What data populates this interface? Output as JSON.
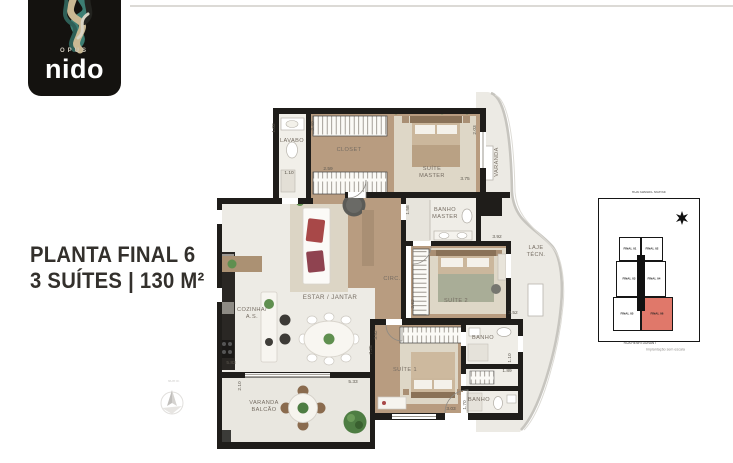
{
  "logo": {
    "brand_top": "OPUS",
    "brand": "nido"
  },
  "title": {
    "line1": "PLANTA FINAL 6",
    "line2": "3 SUÍTES | 130 M²"
  },
  "plan": {
    "rooms": {
      "lavabo": "LAVABO",
      "closet": "CLOSET",
      "suite_master": [
        "SUÍTE",
        "MASTER"
      ],
      "varanda": "VARANDA",
      "banho_master": [
        "BANHO",
        "MASTER"
      ],
      "suite_2": "SUÍTE 2",
      "laje_tecn": [
        "LAJE",
        "TÉCN."
      ],
      "circ": "CIRC.",
      "estar_jantar": "ESTAR / JANTAR",
      "cozinha": [
        "COZINHA/",
        "A.S."
      ],
      "varanda_balcao": [
        "VARANDA",
        "BALCÃO"
      ],
      "suite_1": "SUÍTE 1",
      "banho_1": "BANHO",
      "banho_2": "BANHO"
    },
    "dims": [
      "1.02",
      "1.10",
      "2.40",
      "2.59",
      "2.03",
      "3.75",
      "1.58",
      "3.92",
      "2.62",
      "3.52",
      "7.25",
      "5.83",
      "2.10",
      "5.33",
      "3.52",
      "3.03",
      "1.70",
      "1.10",
      "1.89"
    ],
    "compass_label": "NORTE"
  },
  "keyplan": {
    "street_top": "RUA SAMUEL MORSE",
    "street_bottom": "RUA HENRI DUNANT",
    "units": [
      "FINAL 01",
      "FINAL 02",
      "FINAL 03",
      "FINAL 04",
      "FINAL 05",
      "FINAL 06"
    ],
    "highlight_unit": "FINAL 06",
    "highlight_color": "#e0786a",
    "caption": "Implantação sem escala"
  }
}
